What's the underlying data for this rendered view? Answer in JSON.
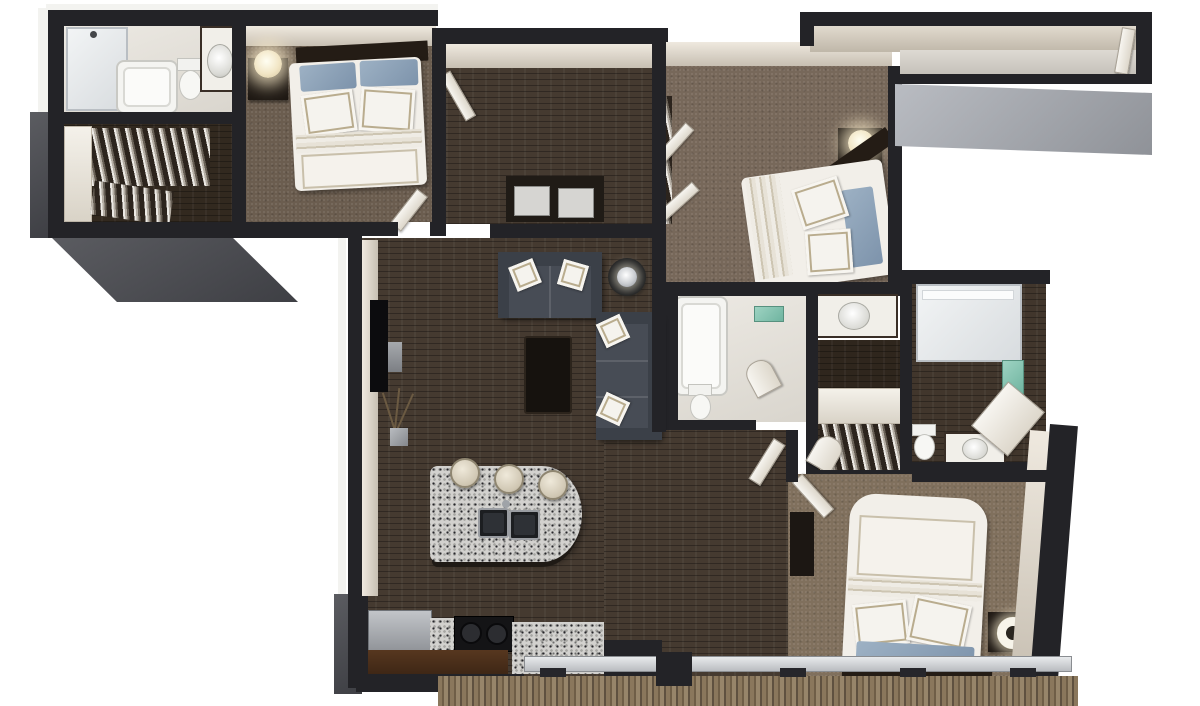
{
  "image": {
    "type": "3d-floor-plan-render",
    "view": "top-down 3D dollhouse view",
    "background": "#ffffff",
    "visible_text": "none"
  },
  "palette": {
    "wall_cut": "#232327",
    "exterior_face_gray": "#9a9ea5",
    "interior_wall_face": "#d9d2c6",
    "wood_floor": "#453a30",
    "carpet": "#77685a",
    "bathroom_floor": "#e9e6e0",
    "granite_counter": "#d2d1ce",
    "sofa_upholstery": "#474c55",
    "bedding_white": "#f2efe9",
    "accent_pillow_blue": "#8ba1b5",
    "towel_accent_teal": "#7fc3b0",
    "deck_wood": "#7c6a50"
  },
  "rooms": [
    {
      "id": "master-bathroom",
      "name": "Master Bathroom",
      "features": [
        "walk-in shower",
        "bathtub",
        "toilet",
        "vanity with sink"
      ]
    },
    {
      "id": "master-closet",
      "name": "Master Walk-in Closet",
      "features": [
        "hanging clothes",
        "white shelving"
      ]
    },
    {
      "id": "master-bedroom",
      "name": "Master Bedroom",
      "features": [
        "bed with white duvet and blue pillows",
        "dark headboard",
        "nightstand",
        "glowing table lamp"
      ]
    },
    {
      "id": "hallway",
      "name": "Hallway",
      "features": [
        "dark wood floor",
        "washer and dryer closet",
        "door to master bedroom"
      ]
    },
    {
      "id": "bedroom-2",
      "name": "Bedroom 2",
      "features": [
        "bed with white duvet and blue pillows",
        "nightstand with lamp",
        "closet with open doors and hanging clothes"
      ]
    },
    {
      "id": "entry-corridor",
      "name": "Entry Corridor",
      "features": [
        "entry door at east end",
        "light floor"
      ]
    },
    {
      "id": "bathroom-2",
      "name": "Bathroom 2",
      "features": [
        "bathtub",
        "teal bath mat",
        "toilet",
        "vanity with sink",
        "arched door"
      ]
    },
    {
      "id": "bathroom-3",
      "name": "Bathroom 3",
      "features": [
        "glass walk-in shower",
        "teal towels",
        "toilet",
        "vanity with sink"
      ]
    },
    {
      "id": "closet-2",
      "name": "Walk-in Closet 2",
      "features": [
        "hanging clothes",
        "white shelf"
      ]
    },
    {
      "id": "living-room",
      "name": "Living Room",
      "features": [
        "charcoal loveseat with two white pillows",
        "charcoal sofa with two white pillows",
        "dark coffee table",
        "round side table with silver lamp",
        "wall TV",
        "dry plant in vase"
      ]
    },
    {
      "id": "kitchen",
      "name": "Kitchen",
      "features": [
        "curved granite island with double sink",
        "three cream bar stools",
        "black range with two burners",
        "stainless refrigerator",
        "dark brown cabinets",
        "granite counters"
      ]
    },
    {
      "id": "bedroom-3",
      "name": "Bedroom 3",
      "features": [
        "bed with white duvet, headboard at south wall",
        "blue accent pillows",
        "nightstand with drum lamp",
        "tall dresser",
        "walk-in closet"
      ]
    },
    {
      "id": "balcony",
      "name": "Balcony",
      "features": [
        "plank wood decking",
        "sliding glass doors"
      ]
    }
  ]
}
